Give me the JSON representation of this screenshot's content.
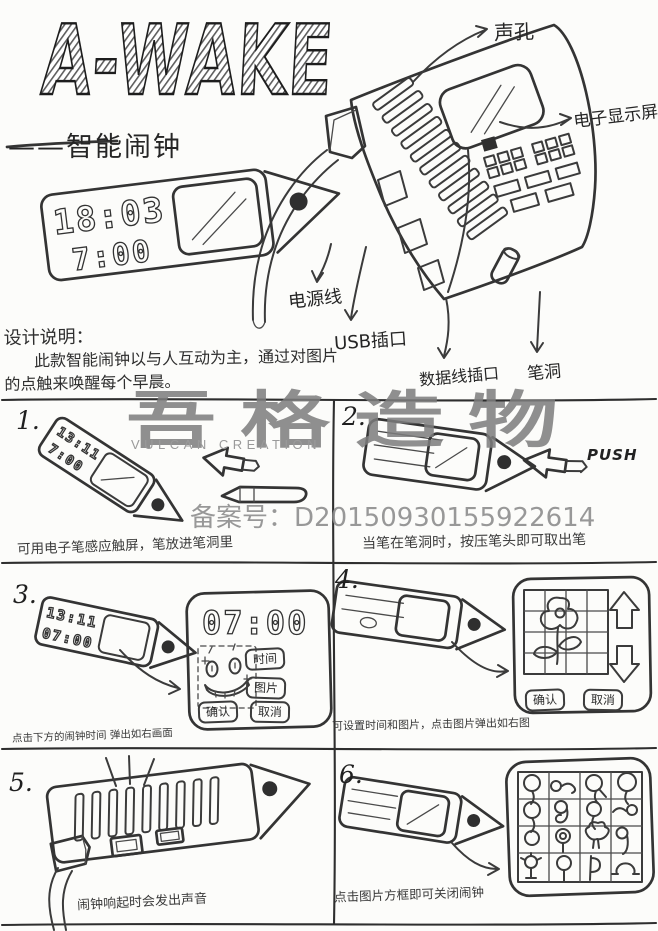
{
  "header": {
    "logo": "A-WAKE",
    "subtitle": "——智能闹钟"
  },
  "annotations": {
    "sound_hole": "声孔",
    "display_screen": "电子显示屏",
    "power_cable": "电源线",
    "usb_port": "USB插口",
    "data_cable_port": "数据线插口",
    "pen_hole": "笔洞"
  },
  "description": {
    "heading": "设计说明：",
    "line1": "此款智能闹钟以与人互动为主，通过对图片",
    "line2": "的点触来唤醒每个早晨。"
  },
  "watermark": {
    "cn": "吾格造物",
    "en": "VULCAN CREATION",
    "registration": "备案号：D20150930155922614"
  },
  "clock": {
    "front_time_top": "18:03",
    "front_time_bottom": "7:00",
    "p1_top": "13:11",
    "p1_bottom": "7:00",
    "p3_top": "13:11",
    "p3_bottom": "07:00",
    "popup_time": "07:00"
  },
  "panels": {
    "p1": {
      "num": "1.",
      "caption": "可用电子笔感应触屏，笔放进笔洞里"
    },
    "p2": {
      "num": "2.",
      "caption": "当笔在笔洞时，按压笔头即可取出笔",
      "push": "PUSH"
    },
    "p3": {
      "num": "3.",
      "caption": "点击下方的闹钟时间 弹出如右画面",
      "btn_time": "时间",
      "btn_picture": "图片",
      "btn_confirm": "确认",
      "btn_cancel": "取消"
    },
    "p4": {
      "num": "4.",
      "caption": "可设置时间和图片，点击图片弹出如右图",
      "btn_confirm": "确认",
      "btn_cancel": "取消"
    },
    "p5": {
      "num": "5.",
      "caption": "闹钟响起时会发出声音"
    },
    "p6": {
      "num": "6.",
      "caption": "点击图片方框即可关闭闹钟"
    }
  }
}
